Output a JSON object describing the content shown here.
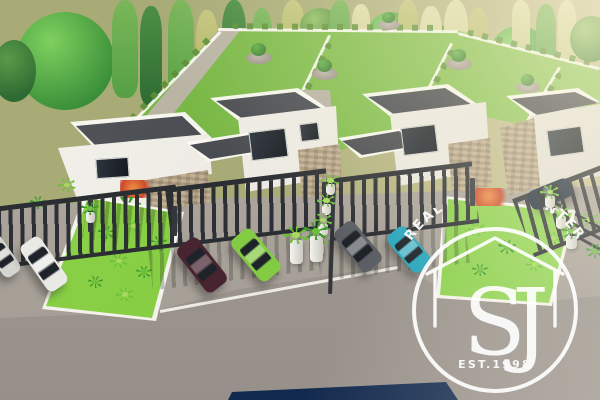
{
  "scene": {
    "description": "Aerial 3D architectural render of a row of modern white villas with dark slatted carports, parked cars, lawns with palms, a road in the foreground and a tree line behind"
  },
  "watermark": {
    "arc_text": "REAL ESTATE CENTER",
    "monogram": "SJ",
    "established": "EST.1998"
  },
  "palette": {
    "ground_olive": "#a8ab76",
    "ground_haze": "#cfc49a",
    "lawn_back": "#7cbb47",
    "lawn_front": "#84cd42",
    "tree_dark": "#2e6b33",
    "tree_mid": "#55a044",
    "tree_yellow": "#a9b257",
    "tree_pale": "#c6cb8e",
    "house_white": "#f3f2ec",
    "house_shade": "#dcd8ce",
    "roof_dark": "#43464b",
    "roof_light": "#54575c",
    "stone_tan": "#c3b194",
    "stone_dark": "#ab9a7e",
    "pergola_dark": "#2a2d32",
    "concrete": "#aaa49b",
    "road_gray": "#a09890",
    "curb_white": "#edebe4",
    "car_white": "#e9e9e6",
    "car_silver": "#d5d5d1",
    "car_maroon": "#482430",
    "car_lime": "#84cb44",
    "car_gray": "#5b5e63",
    "car_teal": "#2aa6bc",
    "car_dark": "#1d2a3a",
    "navy_vehicle": "#1a3560",
    "plant_green": "#3f9a2e",
    "plant_bright": "#6cc13c",
    "flower_red": "#cb4a2b",
    "watermark_white": "#ffffff"
  }
}
